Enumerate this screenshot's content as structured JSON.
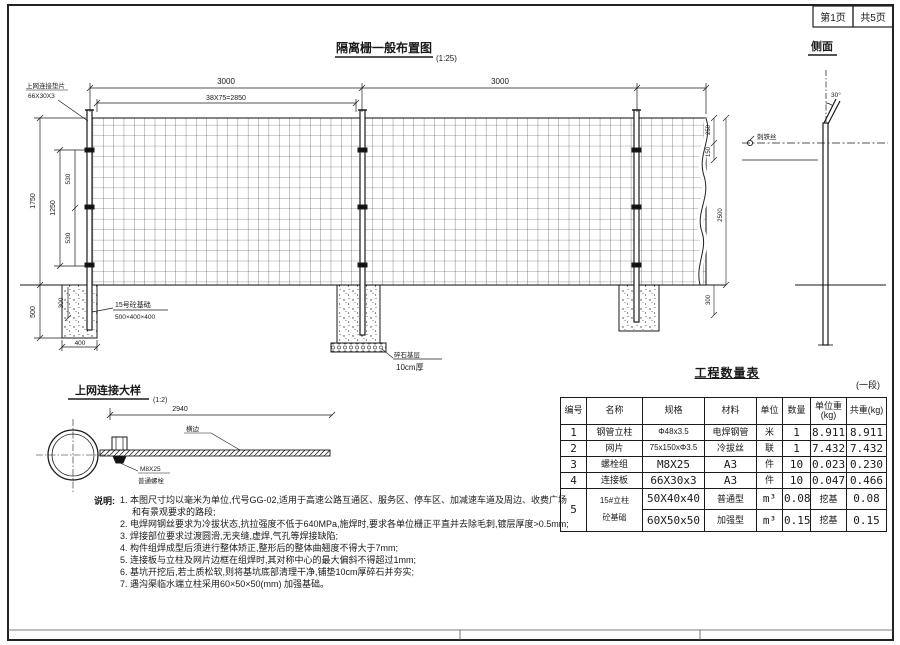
{
  "page": {
    "page_no": "第1页",
    "pages_total": "共5页"
  },
  "main_view": {
    "title": "隔离栅一般布置图",
    "scale": "(1:25)",
    "dims": {
      "span1": "3000",
      "span2": "3000",
      "mesh_pitch": "38X75=2850",
      "height_overall": "1750",
      "height_inner": "1250",
      "seg_top": "530",
      "seg_bottom": "530",
      "depth": "500",
      "embed": "300",
      "footing_width": "400",
      "right_a": "250",
      "right_b": "150",
      "right_post": "2500",
      "right_c": "300"
    },
    "labels": {
      "connector": "上网连接垫片",
      "connector_spec": "66X30X3",
      "foundation": "15号砼基础",
      "foundation_spec": "500×400×400",
      "gravel": "碎石基层",
      "gravel_spec": "10cm厚"
    }
  },
  "side_view": {
    "title": "侧面",
    "angle": "30°",
    "barbed_wire": "刺铁丝"
  },
  "detail_view": {
    "title": "上网连接大样",
    "scale": "(1:2)",
    "dim": "2940",
    "edge_label": "横边",
    "bolt": "M8X25",
    "bolt_type": "普通螺栓"
  },
  "qty_table": {
    "title": "工程数量表",
    "unit_note": "(一段)",
    "headers": [
      "编号",
      "名称",
      "规格",
      "材料",
      "单位",
      "数量",
      "单位重\n(kg)",
      "共重(kg)"
    ],
    "rows": [
      {
        "no": "1",
        "name": "钢管立柱",
        "spec": "Φ48x3.5",
        "material": "电焊钢管",
        "unit": "米",
        "qty": "1",
        "uw": "8.911",
        "tw": "8.911"
      },
      {
        "no": "2",
        "name": "网片",
        "spec": "75x150xΦ3.5",
        "material": "冷拔丝",
        "unit": "联",
        "qty": "1",
        "uw": "7.432",
        "tw": "7.432"
      },
      {
        "no": "3",
        "name": "螺栓组",
        "spec": "M8X25",
        "material": "A3",
        "unit": "件",
        "qty": "10",
        "uw": "0.023",
        "tw": "0.230"
      },
      {
        "no": "4",
        "name": "连接板",
        "spec": "66X30x3",
        "material": "A3",
        "unit": "件",
        "qty": "10",
        "uw": "0.047",
        "tw": "0.466"
      }
    ],
    "row5": {
      "no": "5",
      "name_line1": "15#立柱",
      "name_line2": "砼基础",
      "sub": [
        {
          "spec": "50X40x40",
          "material": "普通型",
          "unit": "m³",
          "qty": "0.08",
          "uw": "挖基",
          "tw": "0.08"
        },
        {
          "spec": "60X50x50",
          "material": "加强型",
          "unit": "m³",
          "qty": "0.15",
          "uw": "挖基",
          "tw": "0.15"
        }
      ]
    }
  },
  "notes": {
    "label": "说明:",
    "items": [
      "1. 本图尺寸均以毫米为单位,代号GG-02,适用于高速公路互通区、服务区、停车区、加减速车道及周边、收费广场和有景观要求的路段;",
      "2. 电焊网钢丝要求为冷拔状态,抗拉强度不低于640MPa,施焊时,要求各单位栅正平直并去除毛刺,镀层厚度>0.5mm;",
      "3. 焊接部位要求过渡圆滑,无夹缝,虚焊,气孔等焊接缺陷;",
      "4. 构件组焊成型后须进行整体矫正,整形后的整体曲翘度不得大于7mm;",
      "5. 连接板与立柱及网片边框在组焊时,其对称中心的最大偏斜不得超过1mm;",
      "6. 基坑开挖后,若土质松软,则将基坑底部清理干净,铺垫10cm厚碎石并夯实;",
      "7. 遇沟渠临水端立柱采用60×50×50(mm) 加强基础。"
    ]
  }
}
